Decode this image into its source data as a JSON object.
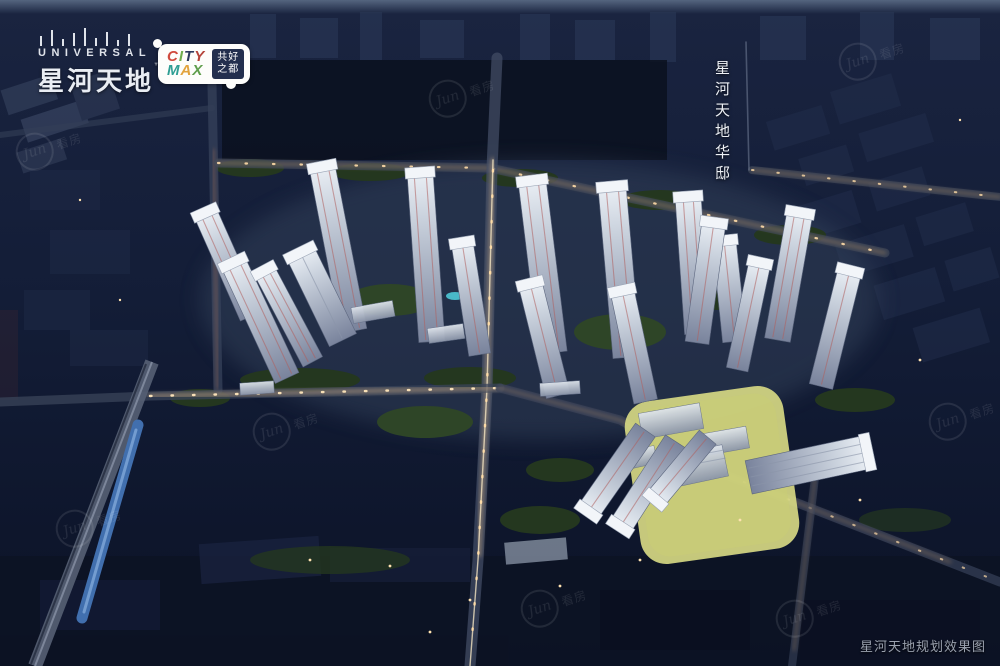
{
  "branding": {
    "universal": {
      "wordmark": "UNIVERSAL",
      "name_cn": "星河天地",
      "tm": "™"
    },
    "citymax": {
      "letters": [
        {
          "ch": "C",
          "style": "color:#d04a3e"
        },
        {
          "ch": "I",
          "style": "color:#6fae4e"
        },
        {
          "ch": "T",
          "style": "color:#2b3a5e"
        },
        {
          "ch": "Y",
          "style": "color:#b5433a"
        },
        {
          "ch": "M",
          "style": "color:#2e9e94"
        },
        {
          "ch": "A",
          "style": "color:#e2a33d"
        },
        {
          "ch": "X",
          "style": "color:#5f9e4c"
        }
      ],
      "tagline": [
        "共好",
        "之都"
      ]
    }
  },
  "overlays": {
    "project_label_vertical": "星河天地华邸",
    "caption": "星河天地规划效果图"
  },
  "watermark": {
    "script": "Jun",
    "text": "看房"
  },
  "colors": {
    "sky_strip": "#51627e",
    "night_base": "#101a31",
    "tower_roof": "#f2f5f9",
    "tower_accent": "#b0605f",
    "plot_highlight": "#d6d883",
    "train_blue": "#416fae",
    "road_glow": "#d8b488"
  }
}
